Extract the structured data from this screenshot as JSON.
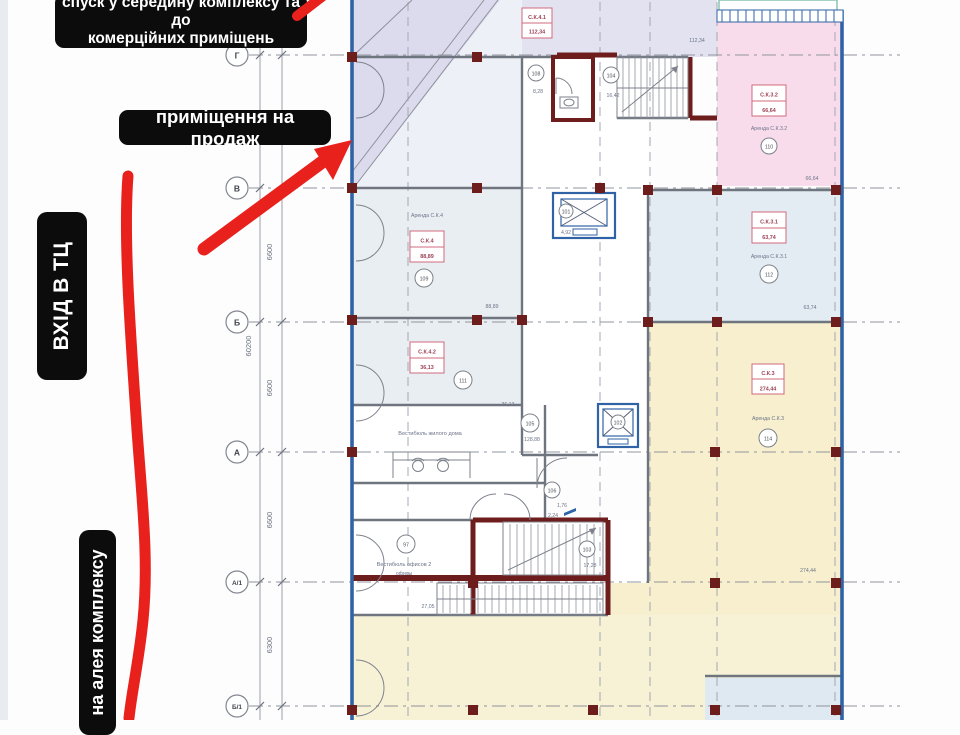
{
  "annotations": {
    "descent_line1": "спуск у середину комплексу та до",
    "descent_line2": "комерційних приміщень",
    "sale": "приміщення на продаж",
    "entrance": "ВХІД В ТЦ",
    "alley": "на алея комплексу"
  },
  "grid": {
    "r0": "Г",
    "r1": "В",
    "r2": "Б",
    "r3": "А",
    "r4": "А/1",
    "r5": "Б/1",
    "d1": "6600",
    "d2": "6600",
    "d3": "6600",
    "d4": "6600",
    "d5": "6300",
    "total": "60200"
  },
  "rooms": {
    "k41": {
      "id": "С.К.4.1",
      "area": "112,34",
      "corner": "112,34"
    },
    "k32": {
      "id": "С.К.3.2",
      "area": "66,64",
      "lease": "Аренда С.К.3.2",
      "tag": "110",
      "corner": "66,64"
    },
    "k4": {
      "id": "С.К.4",
      "area": "88,89",
      "lease": "Аренда С.К.4",
      "tag": "109",
      "corner": "88,89"
    },
    "k31": {
      "id": "С.К.3.1",
      "area": "63,74",
      "lease": "Аренда С.К.3.1",
      "tag": "112",
      "corner": "63,74"
    },
    "k42": {
      "id": "С.К.4.2",
      "area": "36,13",
      "tag": "111",
      "corner": "36,13"
    },
    "k3": {
      "id": "С.К.3",
      "area": "274,44",
      "lease": "Аренда С.К.3",
      "tag": "114",
      "corner": "274,44"
    }
  },
  "texts": {
    "lobby_res": "Вестибюль жилого дома",
    "lobby_off1": "Вестибюль офисов 2",
    "lobby_off2": "офисы"
  },
  "tags": {
    "wc": "108",
    "landing": "104",
    "corridor": "105",
    "hall": "106",
    "stair": "103",
    "office": "97",
    "lift1": "101",
    "lift2": "102"
  },
  "areas": {
    "wc": "8,28",
    "landing": "16,42",
    "lift1": "4,92",
    "corridor": "128,88",
    "stair": "17,28",
    "lobby": "27,05",
    "a1": "1,76",
    "a2": "2,24"
  },
  "colors": {
    "red_marker": "#e8211d",
    "label_bg": "#0c0c0c",
    "pink_zone": "#f8dcec",
    "yellow_zone": "#f7efce",
    "lavender_zone": "#dcdbee",
    "blue_wall": "#2f63a6",
    "maroon": "#6e1d1d"
  }
}
